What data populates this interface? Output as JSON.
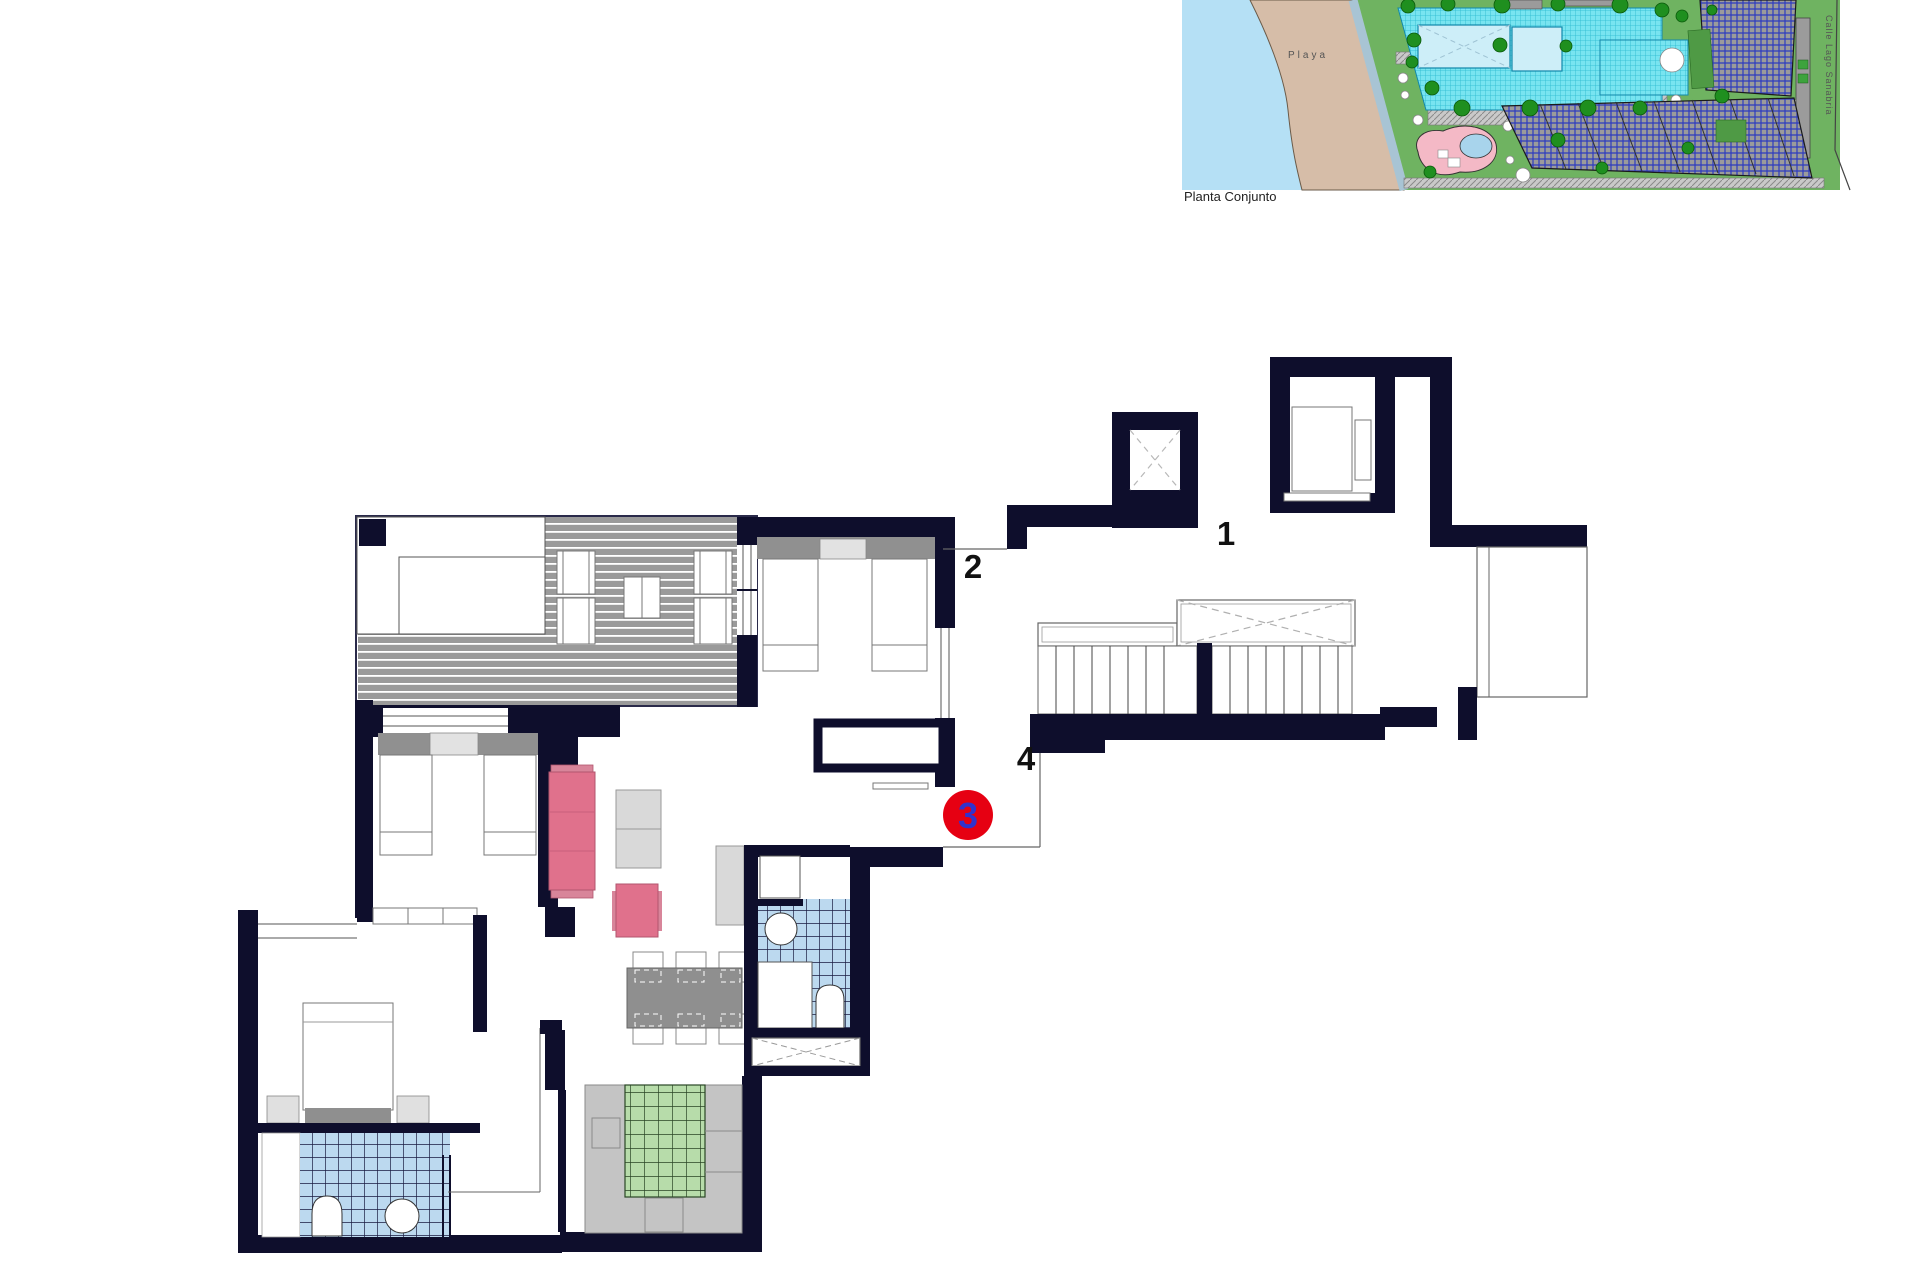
{
  "site_plan": {
    "caption": "Planta Conjunto",
    "beach_label": "Playa",
    "street_label": "Calle Lago Sanabria",
    "colors": {
      "water": "#b5e0f5",
      "sand": "#d6bda8",
      "grass": "#6fb361",
      "pool_deck": "#78e4f0",
      "pool_water": "#cdeef8",
      "tree": "#1f8f1f",
      "building_gray": "#9b9b9b",
      "building_lines_blue": "#2d3bc0",
      "playground_pink": "#f4b9c6"
    }
  },
  "floor_plan": {
    "labels": {
      "unit_1": "1",
      "unit_2": "2",
      "unit_4": "4"
    },
    "marker": {
      "number": "3",
      "circle_color": "#e60012",
      "number_color": "#3232cc"
    },
    "colors": {
      "wall": "#0e0e2c",
      "deck_gray": "#9a9a9a",
      "bath_tile": "#bcd9ef",
      "kitchen_tile": "#b7dcaa",
      "sofa_pink": "#e0718c",
      "furniture_gray": "#d9d9d9",
      "dining_table_gray": "#8f8f8f",
      "counter_gray": "#c4c4c4"
    }
  }
}
